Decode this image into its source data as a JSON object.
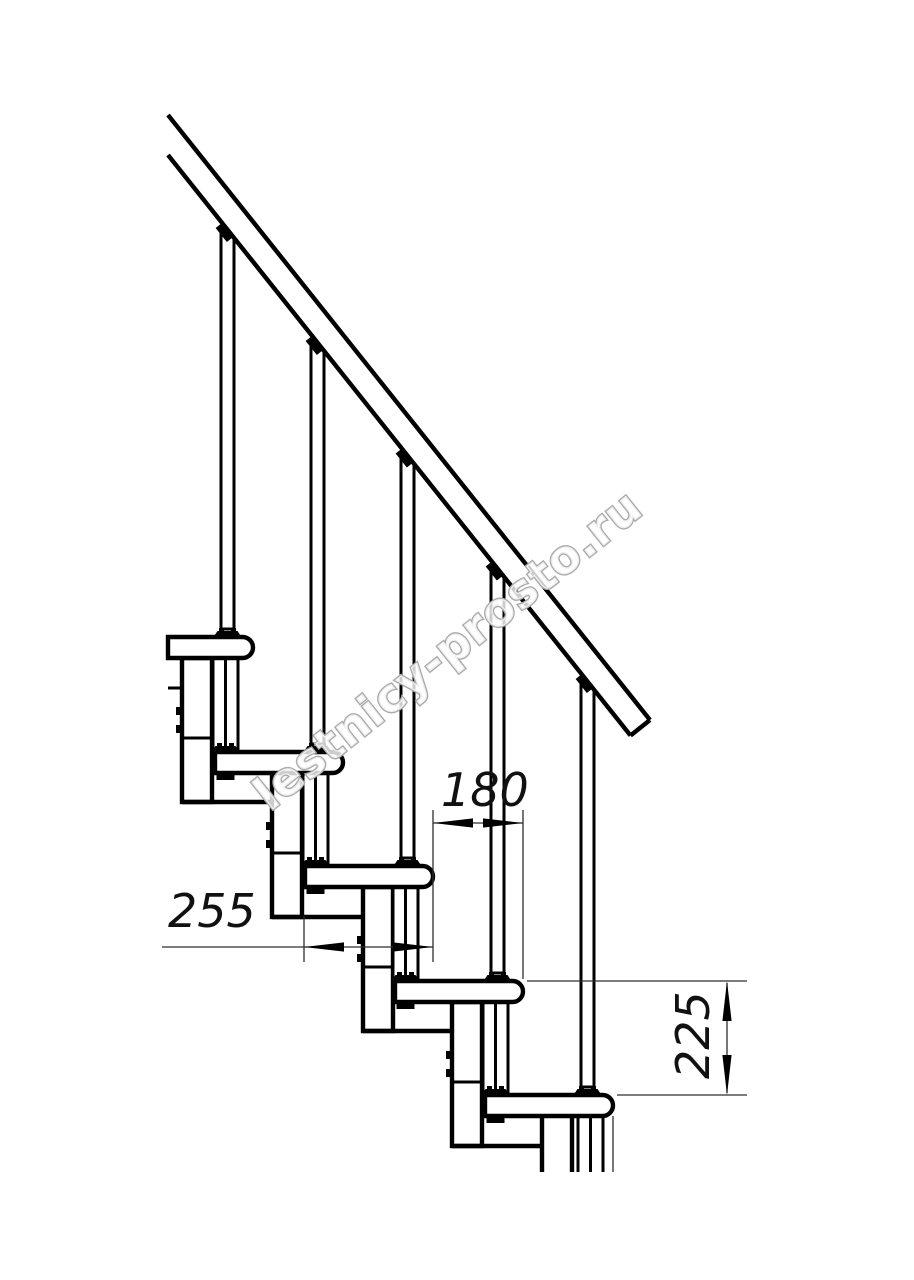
{
  "drawing": {
    "type": "staircase-fragment-side-view",
    "dimension_labels": {
      "tread_depth": "255",
      "step_run": "180",
      "step_rise": "225"
    },
    "watermark": "lestnicy-prosto.ru",
    "colors": {
      "line": "#000000",
      "thin_line": "#2e2e2e",
      "background": "#ffffff",
      "watermark_outline": "#a9a9a9"
    }
  }
}
